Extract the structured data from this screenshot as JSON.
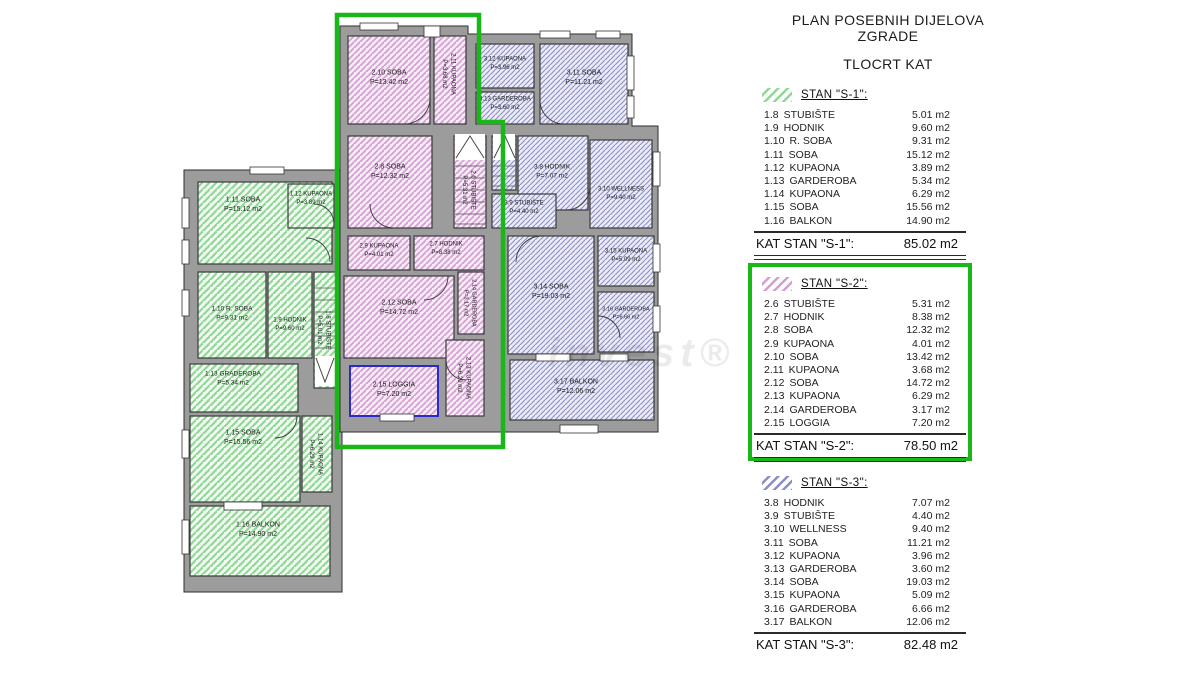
{
  "page": {
    "title1": "PLAN POSEBNIH DIJELOVA ZGRADE",
    "title2": "TLOCRT KAT",
    "watermark": "invest®"
  },
  "colors": {
    "highlight": "#17b817",
    "wall": "#9c9c9c",
    "wall_stroke": "#2e2e2e",
    "s1_line": "#8fd896",
    "s1_bg": "#f2faf2",
    "s2_line": "#d49fd2",
    "s2_bg": "#f7ecf6",
    "s3_line": "#8c8fc6",
    "s3_bg": "#ebebf6",
    "loggia_border": "#2a2acc"
  },
  "apartments": [
    {
      "id": "s1",
      "header": "STAN \"S-1\":",
      "highlighted": false,
      "rows": [
        [
          "1.8",
          "STUBIŠTE",
          "5.01 m2"
        ],
        [
          "1.9",
          "HODNIK",
          "9.60 m2"
        ],
        [
          "1.10",
          "R. SOBA",
          "9.31 m2"
        ],
        [
          "1.11",
          "SOBA",
          "15.12 m2"
        ],
        [
          "1.12",
          "KUPAONA",
          "3.89 m2"
        ],
        [
          "1.13",
          "GARDEROBA",
          "5.34 m2"
        ],
        [
          "1.14",
          "KUPAONA",
          "6.29 m2"
        ],
        [
          "1.15",
          "SOBA",
          "15.56 m2"
        ],
        [
          "1.16",
          "BALKON",
          "14.90 m2"
        ]
      ],
      "total_label": "KAT STAN \"S-1\":",
      "total_value": "85.02 m2",
      "double_rule": true
    },
    {
      "id": "s2",
      "header": "STAN \"S-2\":",
      "highlighted": true,
      "rows": [
        [
          "2.6",
          "STUBIŠTE",
          "5.31 m2"
        ],
        [
          "2.7",
          "HODNIK",
          "8.38 m2"
        ],
        [
          "2.8",
          "SOBA",
          "12.32 m2"
        ],
        [
          "2.9",
          "KUPAONA",
          "4.01 m2"
        ],
        [
          "2.10",
          "SOBA",
          "13.42 m2"
        ],
        [
          "2.11",
          "KUPAONA",
          "3.68 m2"
        ],
        [
          "2.12",
          "SOBA",
          "14.72 m2"
        ],
        [
          "2.13",
          "KUPAONA",
          "6.29 m2"
        ],
        [
          "2.14",
          "GARDEROBA",
          "3.17 m2"
        ],
        [
          "2.15",
          "LOGGIA",
          "7.20 m2"
        ]
      ],
      "total_label": "KAT STAN \"S-2\":",
      "total_value": "78.50 m2",
      "double_rule": true
    },
    {
      "id": "s3",
      "header": "STAN \"S-3\":",
      "highlighted": false,
      "rows": [
        [
          "3.8",
          "HODNIK",
          "7.07 m2"
        ],
        [
          "3.9",
          "STUBIŠTE",
          "4.40 m2"
        ],
        [
          "3.10",
          "WELLNESS",
          "9.40 m2"
        ],
        [
          "3.11",
          "SOBA",
          "11.21 m2"
        ],
        [
          "3.12",
          "KUPAONA",
          "3.96 m2"
        ],
        [
          "3.13",
          "GARDEROBA",
          "3.60 m2"
        ],
        [
          "3.14",
          "SOBA",
          "19.03 m2"
        ],
        [
          "3.15",
          "KUPAONA",
          "5.09 m2"
        ],
        [
          "3.16",
          "GARDEROBA",
          "6.66 m2"
        ],
        [
          "3.17",
          "BALKON",
          "12.06 m2"
        ]
      ],
      "total_label": "KAT STAN \"S-3\":",
      "total_value": "82.48 m2",
      "double_rule": false
    }
  ],
  "plan": {
    "rooms": [
      {
        "apt": "s1",
        "line1": "1.11 SOBA",
        "line2": "P=15.12 m2",
        "x": 198,
        "y": 182,
        "w": 134,
        "h": 82,
        "lx": 243,
        "ly": 203
      },
      {
        "apt": "s1",
        "line1": "1.12 KUPAONA",
        "line2": "P=3.89 m2",
        "x": 288,
        "y": 184,
        "w": 46,
        "h": 44,
        "lx": 311,
        "ly": 197,
        "fs": 6
      },
      {
        "apt": "s1",
        "line1": "1.10 R. SOBA",
        "line2": "P=9.31 m2",
        "x": 198,
        "y": 272,
        "w": 68,
        "h": 86,
        "lx": 232,
        "ly": 312,
        "fs": 6.5
      },
      {
        "apt": "s1",
        "line1": "1.9 HODNIK",
        "line2": "P=9.60 m2",
        "x": 268,
        "y": 272,
        "w": 44,
        "h": 86,
        "lx": 290,
        "ly": 323,
        "fs": 6
      },
      {
        "apt": "s1",
        "line1": "1.8 STUBIŠTE",
        "line2": "P=5.01 m2",
        "x": 314,
        "y": 272,
        "w": 22,
        "h": 116,
        "vertical": true,
        "fs": 6
      },
      {
        "apt": "s1",
        "line1": "1.13 GRADEROBA",
        "line2": "P=5.34 m2",
        "x": 190,
        "y": 364,
        "w": 108,
        "h": 48,
        "lx": 233,
        "ly": 377,
        "fs": 6.5
      },
      {
        "apt": "s1",
        "line1": "1.15 SOBA",
        "line2": "P=15.56 m2",
        "x": 190,
        "y": 416,
        "w": 110,
        "h": 86,
        "lx": 243,
        "ly": 436
      },
      {
        "apt": "s1",
        "line1": "1.14 KUPAONA",
        "line2": "P=6.29 m2",
        "x": 302,
        "y": 416,
        "w": 30,
        "h": 76,
        "vertical": true,
        "fs": 6
      },
      {
        "apt": "s1",
        "line1": "1.16 BALKON",
        "line2": "P=14.90 m2",
        "x": 190,
        "y": 506,
        "w": 140,
        "h": 70,
        "lx": 258,
        "ly": 528
      },
      {
        "apt": "s2",
        "line1": "2.10 SOBA",
        "line2": "P=13.42 m2",
        "x": 348,
        "y": 36,
        "w": 82,
        "h": 88,
        "lx": 389,
        "ly": 76
      },
      {
        "apt": "s2",
        "line1": "2.11 KUPAONA",
        "line2": "P=3.68 m2",
        "x": 434,
        "y": 36,
        "w": 32,
        "h": 88,
        "vertical": true,
        "lx": 450,
        "ly": 74,
        "fs": 6
      },
      {
        "apt": "s2",
        "line1": "2.8 SOBA",
        "line2": "P=12.32 m2",
        "x": 348,
        "y": 136,
        "w": 84,
        "h": 92,
        "lx": 390,
        "ly": 170
      },
      {
        "apt": "s2",
        "line1": "2.6 STUBIŠTE",
        "line2": "P=5.31 m2",
        "x": 454,
        "y": 136,
        "w": 32,
        "h": 92,
        "vertical": true,
        "lx": 470,
        "ly": 190,
        "fs": 6
      },
      {
        "apt": "s2",
        "line1": "2.9 KUPAONA",
        "line2": "P=4.01 m2",
        "x": 348,
        "y": 236,
        "w": 62,
        "h": 34,
        "lx": 379,
        "ly": 249,
        "fs": 6
      },
      {
        "apt": "s2",
        "line1": "2.7 HODNIK",
        "line2": "P=8.38 m2",
        "x": 414,
        "y": 236,
        "w": 70,
        "h": 34,
        "lx": 446,
        "ly": 247,
        "fs": 6
      },
      {
        "apt": "s2",
        "line1": "2.12 SOBA",
        "line2": "P=14.72 m2",
        "x": 344,
        "y": 276,
        "w": 110,
        "h": 82,
        "lx": 399,
        "ly": 306
      },
      {
        "apt": "s2",
        "line1": "2.14 GARDEROBA",
        "line2": "P=3.17 m2",
        "x": 458,
        "y": 272,
        "w": 26,
        "h": 62,
        "vertical": true,
        "fs": 5.5
      },
      {
        "apt": "s2",
        "line1": "2.13 KUPAONA",
        "line2": "P=6.29 m2",
        "x": 446,
        "y": 340,
        "w": 38,
        "h": 76,
        "vertical": true,
        "fs": 6
      },
      {
        "apt": "s2",
        "line1": "2.15 LOGGIA",
        "line2": "P=7.20 m2",
        "x": 350,
        "y": 366,
        "w": 88,
        "h": 50,
        "lx": 394,
        "ly": 388,
        "loggia": true
      },
      {
        "apt": "s3",
        "line1": "3.12 KUPAONA",
        "line2": "P=3.96 m2",
        "x": 476,
        "y": 44,
        "w": 58,
        "h": 44,
        "lx": 505,
        "ly": 62,
        "fs": 6
      },
      {
        "apt": "s3",
        "line1": "3.13 GARDEROBA",
        "line2": "P=3.60 m2",
        "x": 476,
        "y": 92,
        "w": 58,
        "h": 32,
        "lx": 505,
        "ly": 102,
        "fs": 6
      },
      {
        "apt": "s3",
        "line1": "3.11 SOBA",
        "line2": "P=11.21 m2",
        "x": 540,
        "y": 44,
        "w": 88,
        "h": 80,
        "lx": 584,
        "ly": 76
      },
      {
        "apt": "s3",
        "line1": "",
        "line2": "",
        "x": 492,
        "y": 136,
        "w": 24,
        "h": 54
      },
      {
        "apt": "s3",
        "line1": "3.8 HODNIK",
        "line2": "P=7.07 m2",
        "x": 518,
        "y": 136,
        "w": 70,
        "h": 74,
        "lx": 552,
        "ly": 170,
        "fs": 6.5
      },
      {
        "apt": "s3",
        "line1": "3.9 STUBIŠTE",
        "line2": "P=4.40 m2",
        "x": 492,
        "y": 194,
        "w": 64,
        "h": 34,
        "lx": 524,
        "ly": 206,
        "fs": 6
      },
      {
        "apt": "s3",
        "line1": "3.10 WELLNESS",
        "line2": "P=9.40 m2",
        "x": 590,
        "y": 140,
        "w": 62,
        "h": 88,
        "lx": 621,
        "ly": 192,
        "fs": 6
      },
      {
        "apt": "s3",
        "line1": "3.14 SOBA",
        "line2": "P=19.03 m2",
        "x": 508,
        "y": 236,
        "w": 86,
        "h": 118,
        "lx": 551,
        "ly": 290
      },
      {
        "apt": "s3",
        "line1": "3.15 KUPAONA",
        "line2": "P=5.09 m2",
        "x": 598,
        "y": 236,
        "w": 56,
        "h": 50,
        "lx": 626,
        "ly": 254,
        "fs": 6
      },
      {
        "apt": "s3",
        "line1": "3.16 GARDEROBA",
        "line2": "P=6.66 m2",
        "x": 598,
        "y": 292,
        "w": 56,
        "h": 60,
        "lx": 626,
        "ly": 312,
        "fs": 5.5
      },
      {
        "apt": "s3",
        "line1": "3.17 BALKON",
        "line2": "P=12.06 m2",
        "x": 510,
        "y": 360,
        "w": 144,
        "h": 60,
        "lx": 576,
        "ly": 385
      }
    ]
  }
}
